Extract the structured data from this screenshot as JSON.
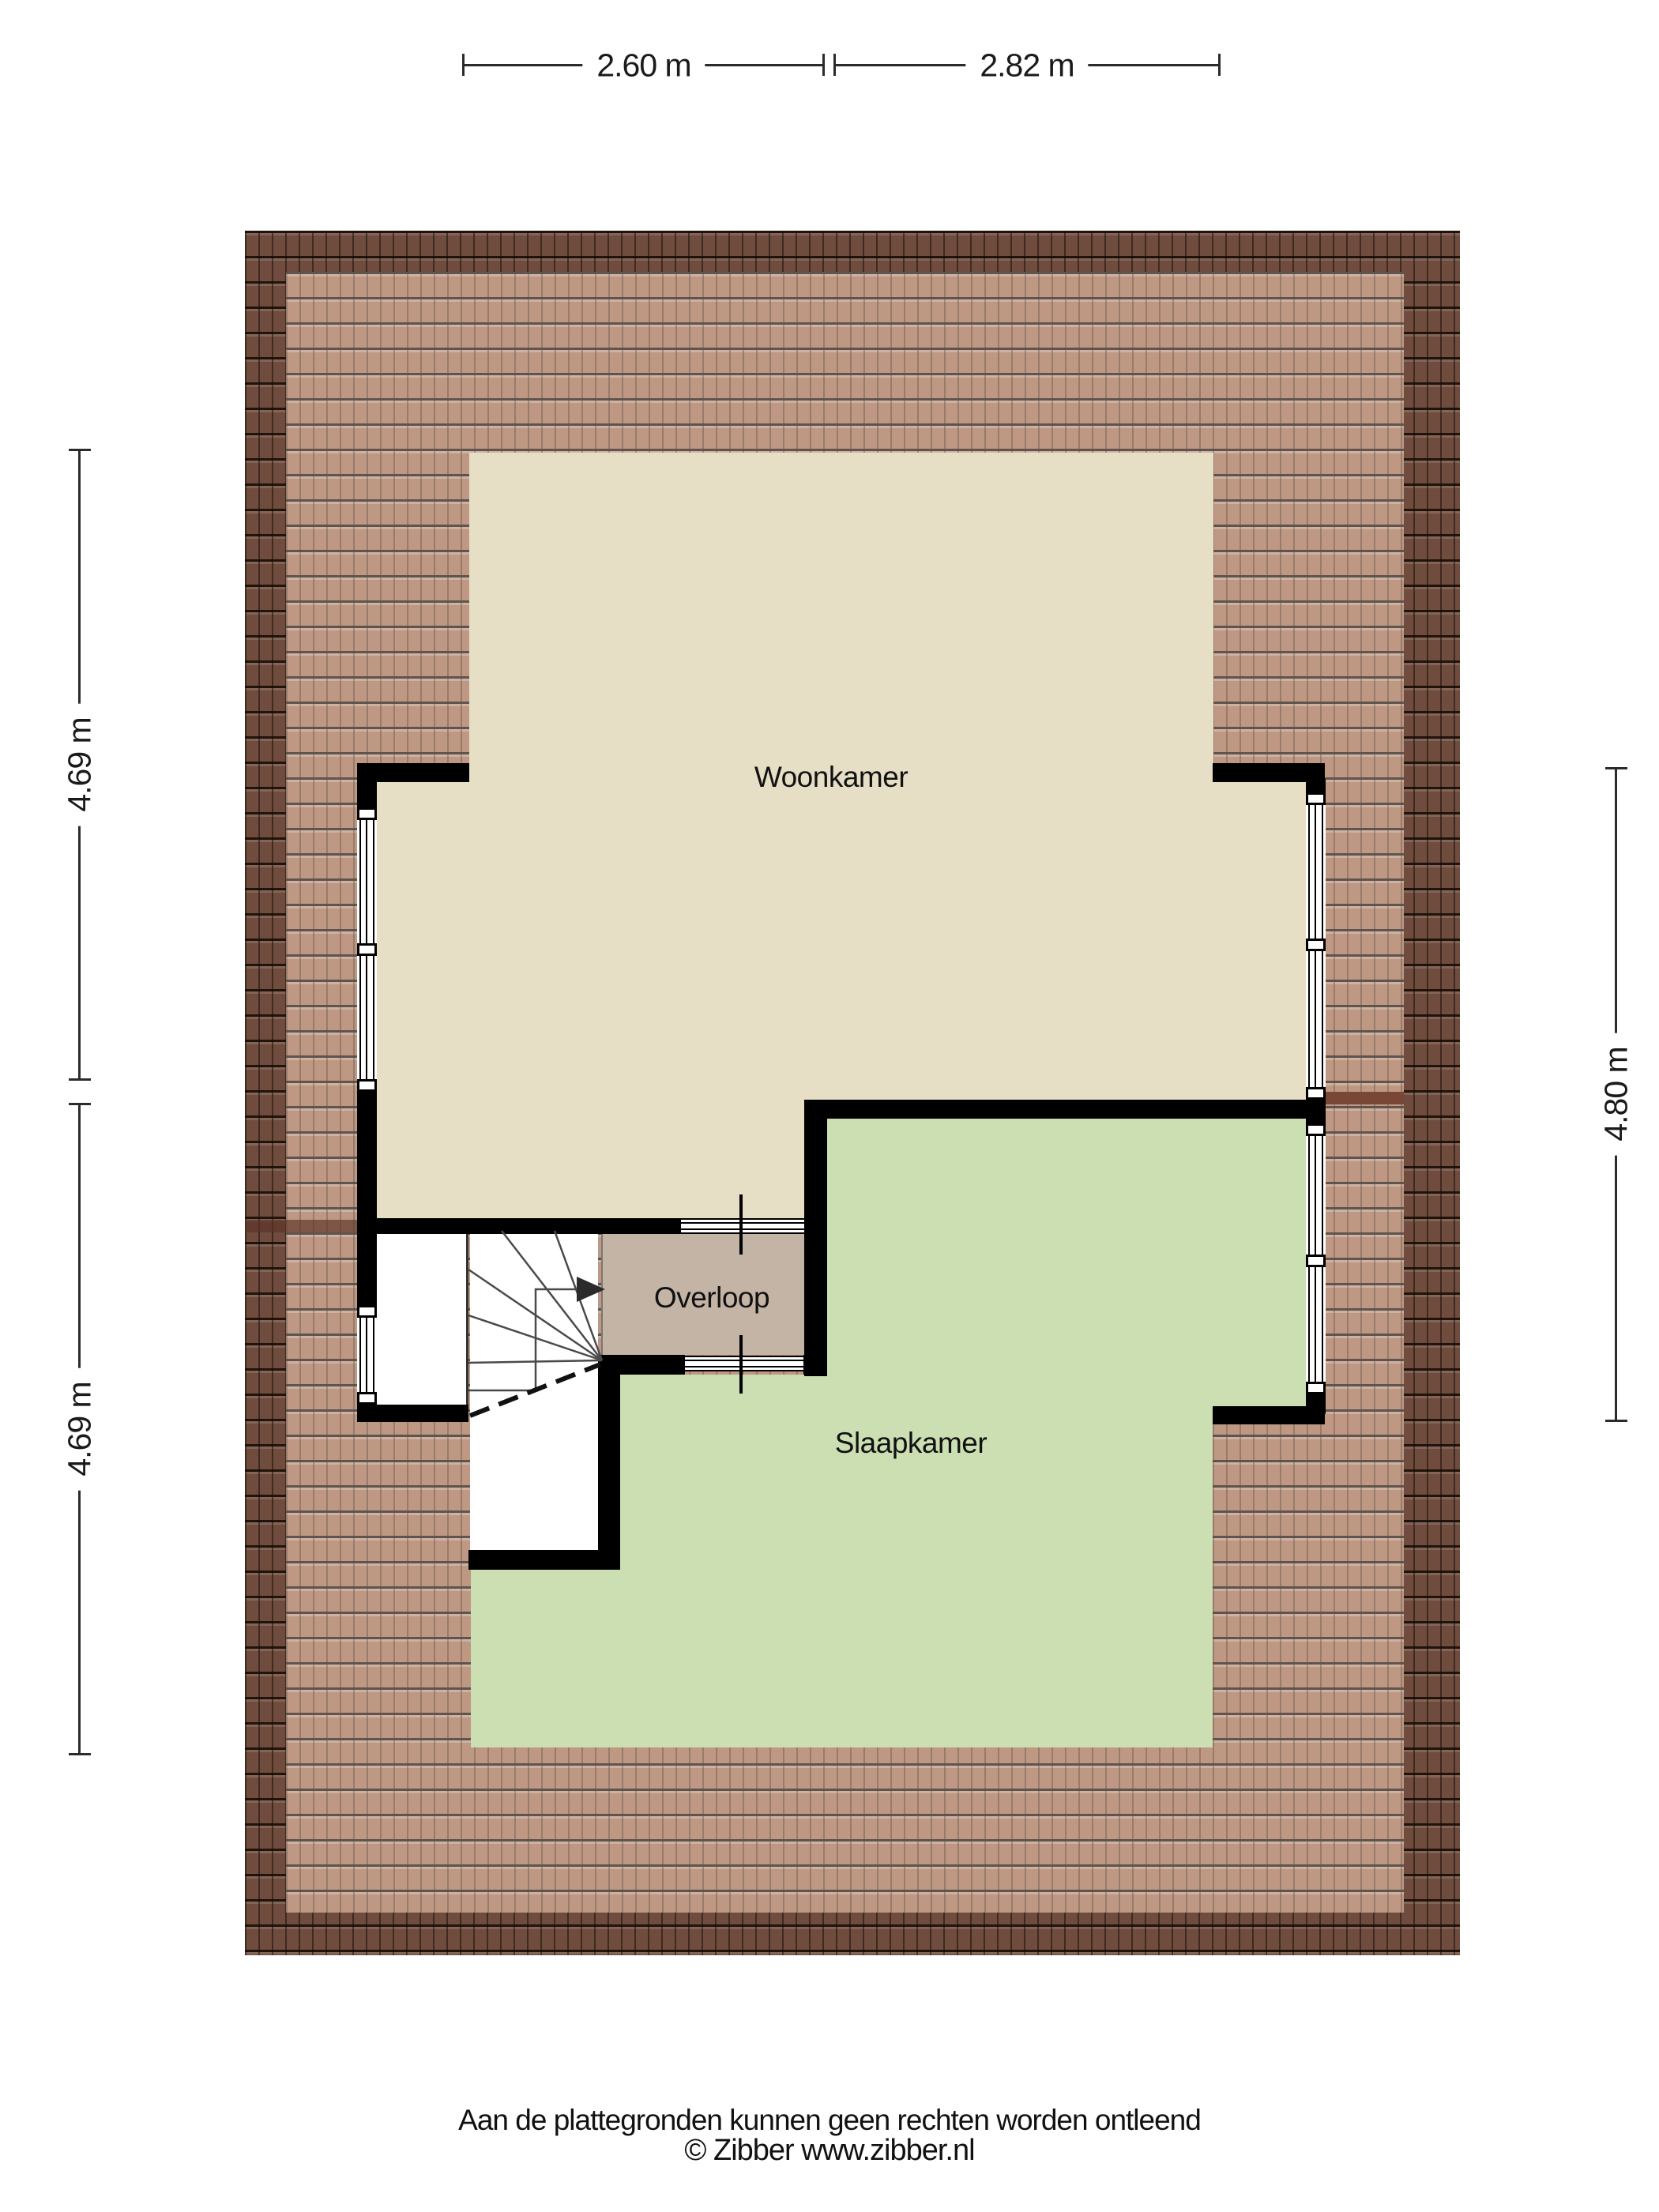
{
  "plan": {
    "footer_line1": "Aan de plattegronden kunnen geen rechten worden ontleend",
    "footer_line2": "© Zibber www.zibber.nl"
  },
  "rooms": {
    "woonkamer": {
      "label": "Woonkamer"
    },
    "overloop": {
      "label": "Overloop"
    },
    "slaapkamer": {
      "label": "Slaapkamer"
    }
  },
  "dimensions": {
    "top": [
      {
        "label": "2.60 m"
      },
      {
        "label": "2.82 m"
      }
    ],
    "left": [
      {
        "label": "4.69 m"
      },
      {
        "label": "4.69 m"
      }
    ],
    "right": [
      {
        "label": "4.80 m"
      }
    ]
  },
  "colors": {
    "floor_woonkamer": "#e6dec5",
    "floor_slaapkamer": "#cbdfb2",
    "floor_overloop": "#c4b4a5",
    "roof_tile_light": "#b1846a",
    "roof_tile_dark": "#6f4c3d",
    "roof_seam": "#7a4737",
    "wall": "#000000",
    "dimension_text": "#1a1a1a"
  }
}
